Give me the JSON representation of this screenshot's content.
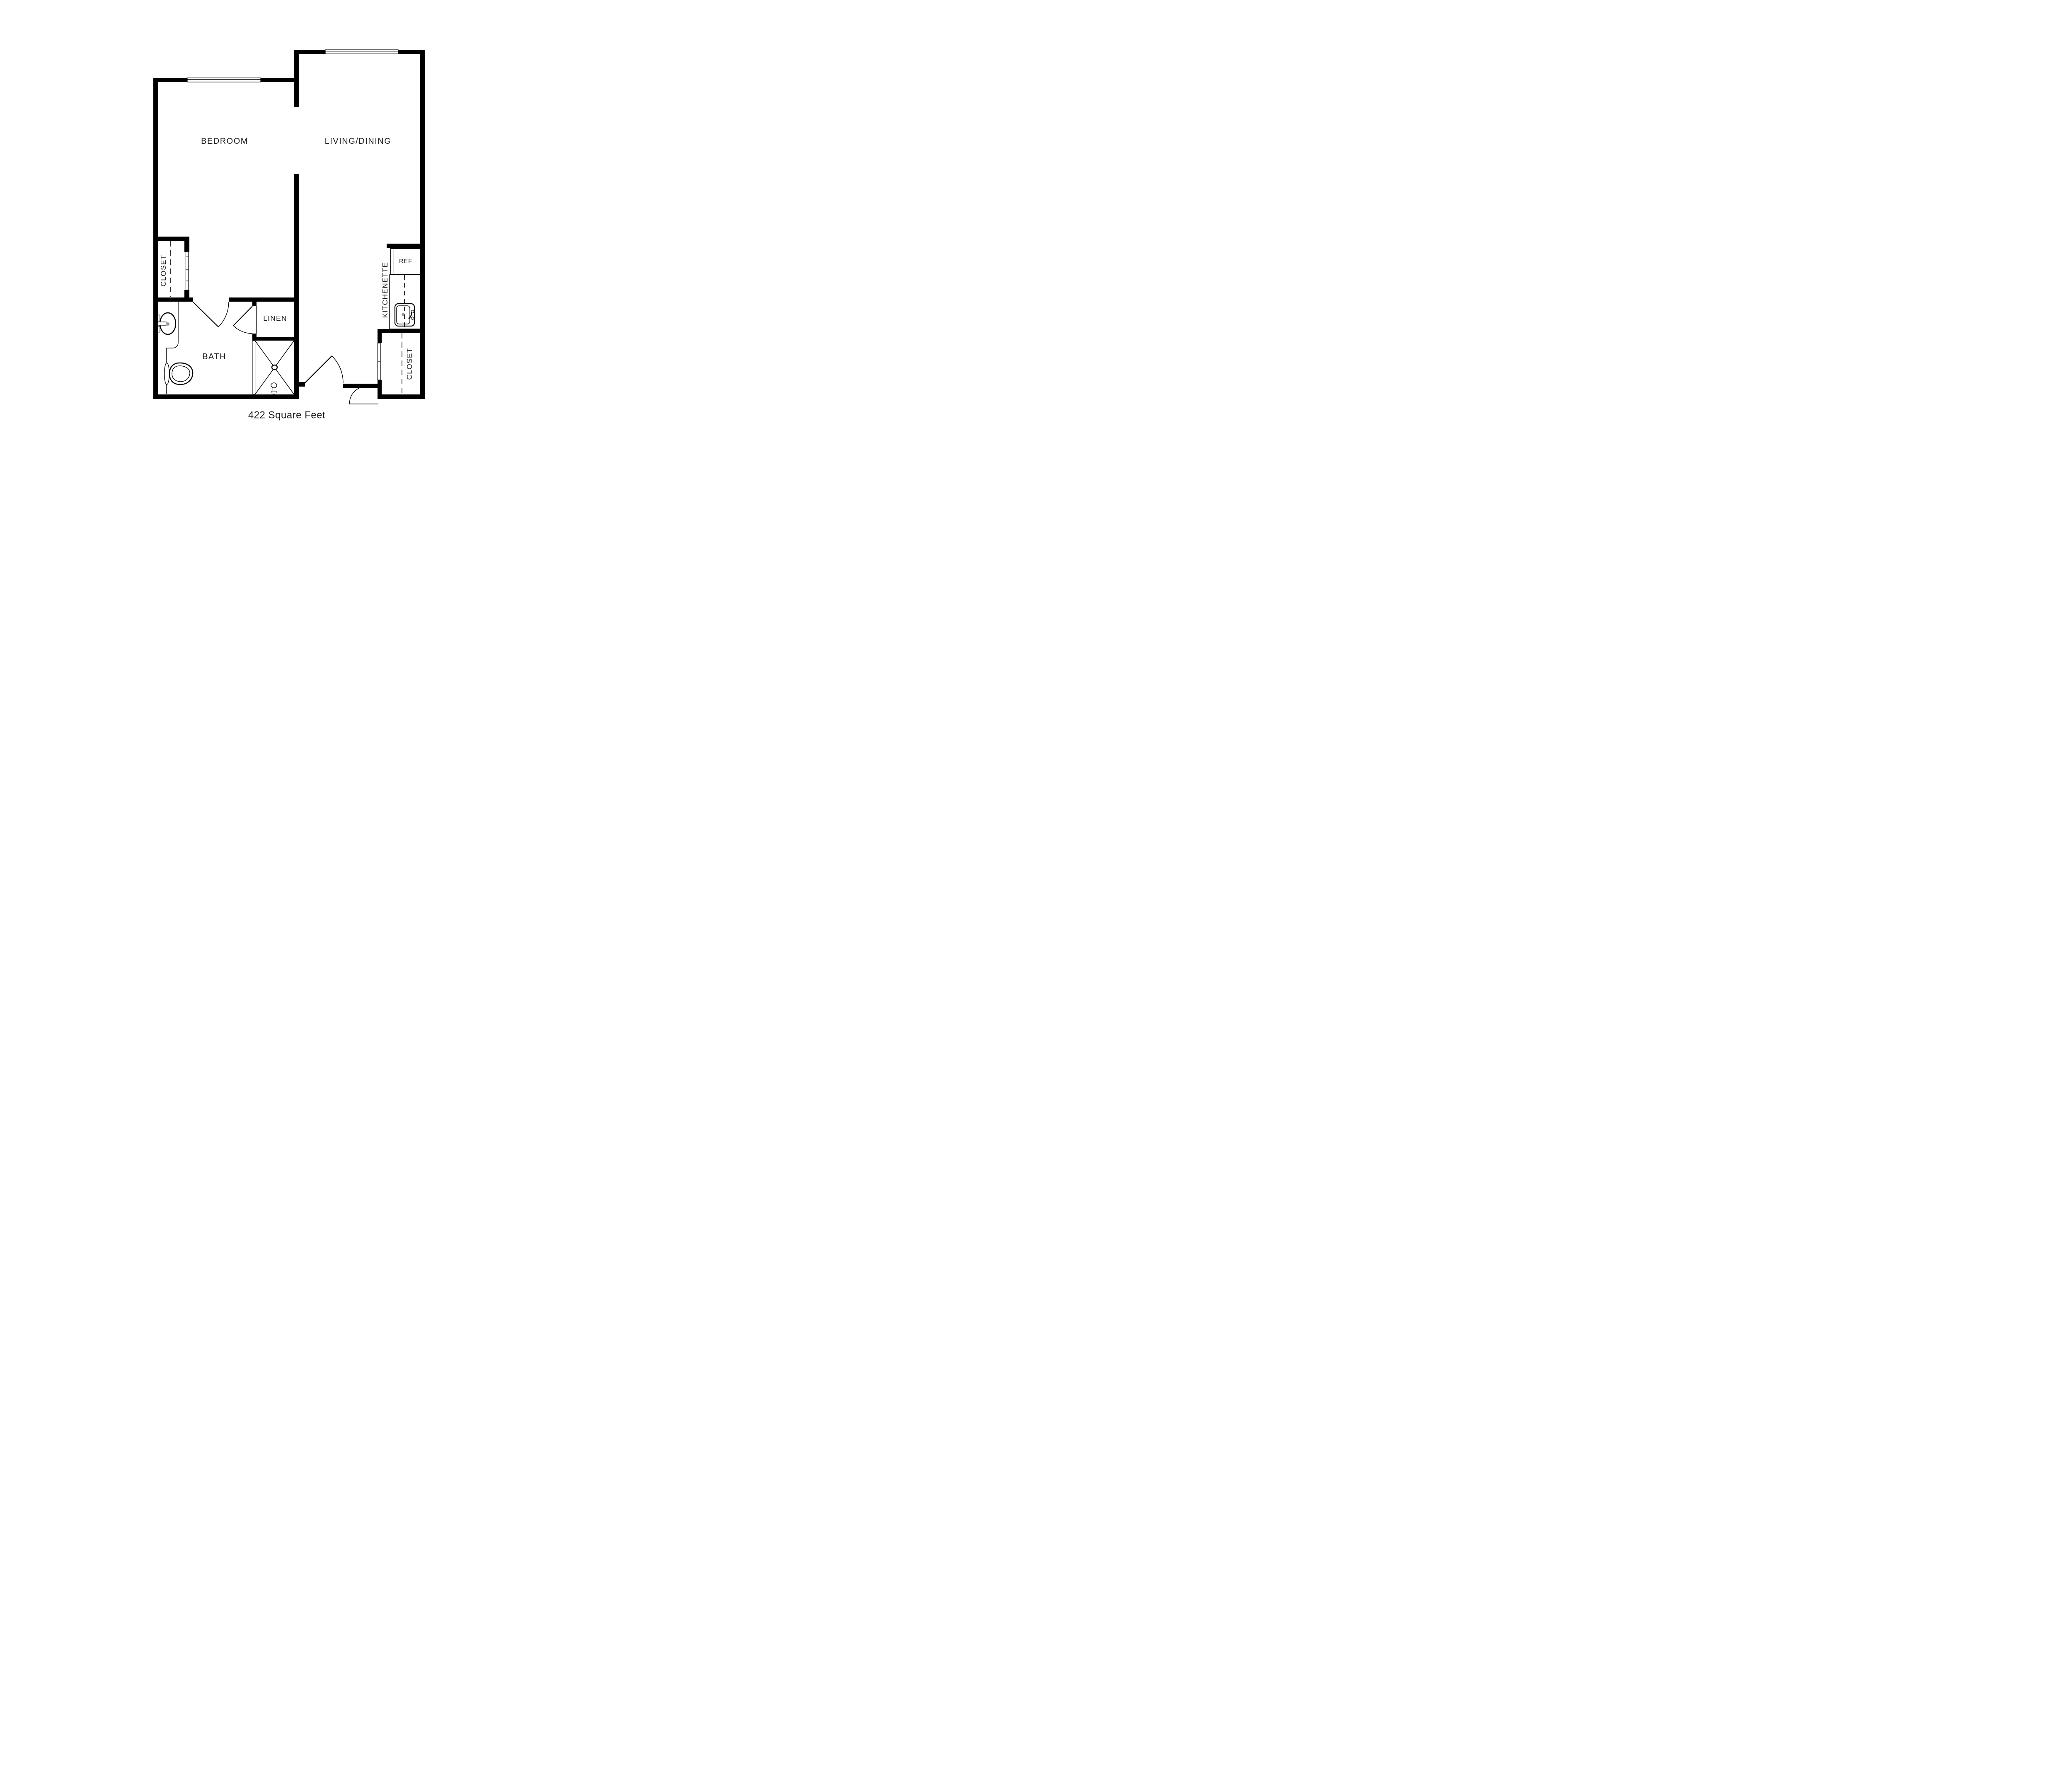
{
  "plan": {
    "caption": "422 Square Feet",
    "labels": {
      "bedroom": "BEDROOM",
      "living_dining": "LIVING/DINING",
      "bath": "BATH",
      "linen": "LINEN",
      "kitchenette": "KITCHENETTE",
      "ref": "REF",
      "closet_bedroom": "CLOSET",
      "closet_entry": "CLOSET"
    },
    "colors": {
      "wall": "#000000",
      "line": "#000000",
      "drain": "#9a9a9a",
      "text": "#1c1c1c",
      "background": "#ffffff"
    }
  }
}
